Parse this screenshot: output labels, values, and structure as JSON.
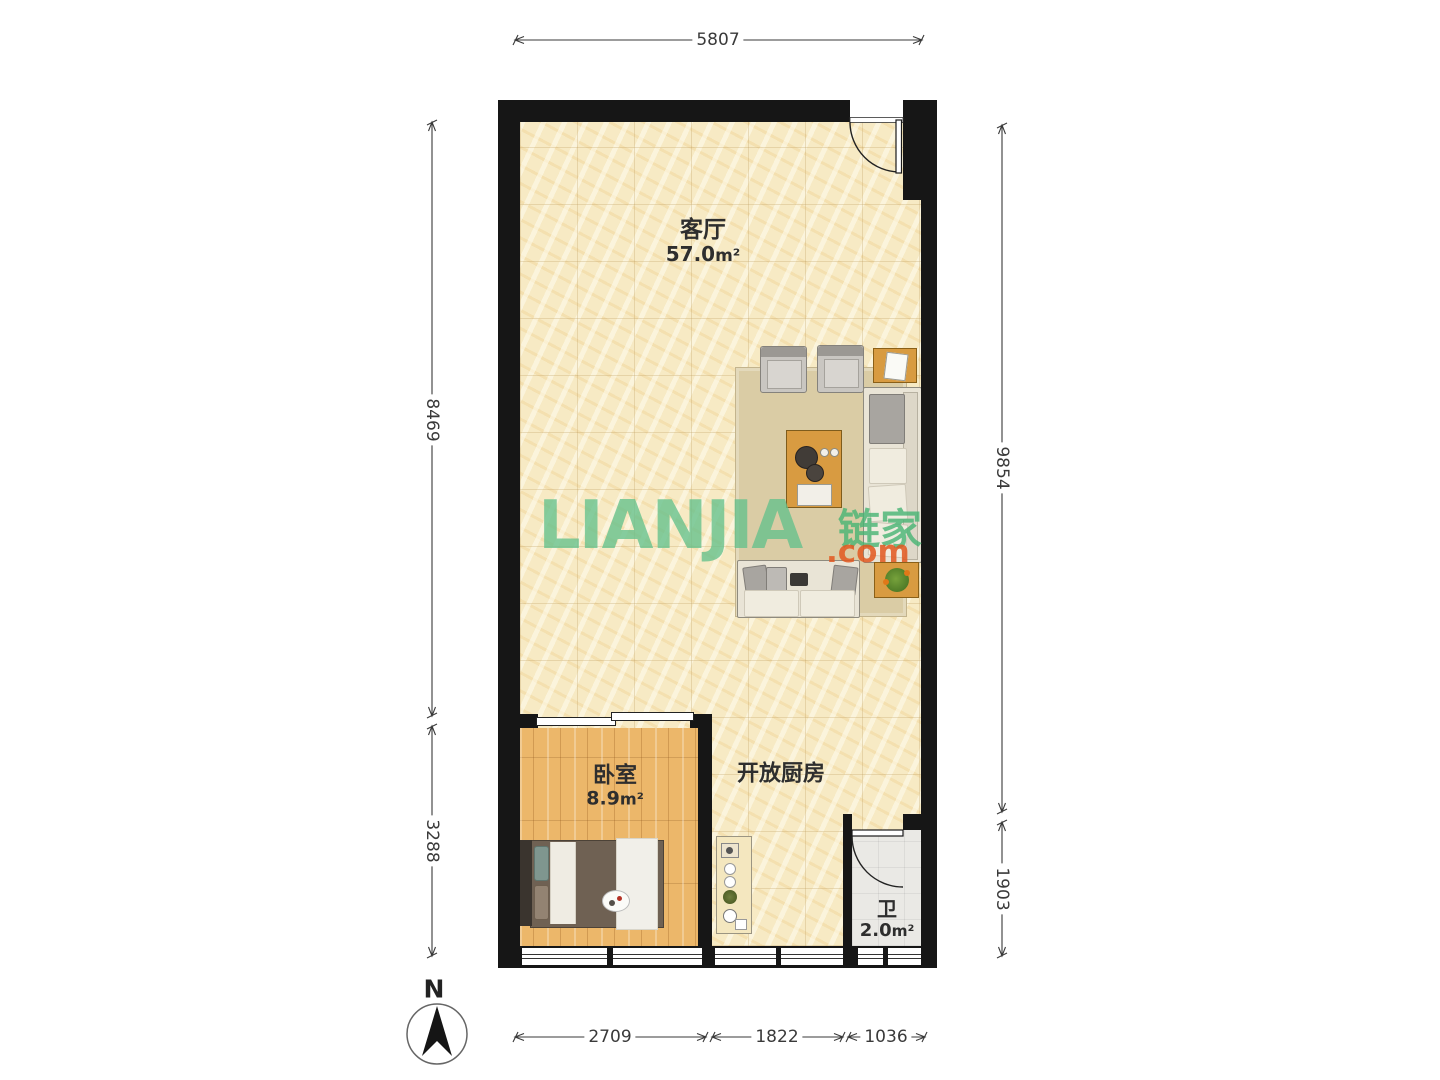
{
  "watermark": {
    "wordmark": "LIANJIA",
    "cn": "链家",
    "domain": ".com"
  },
  "rooms": {
    "living": {
      "name": "客厅",
      "area": "57.0",
      "unit": "m²"
    },
    "bedroom": {
      "name": "卧室",
      "area": "8.9",
      "unit": "m²"
    },
    "kitchen": {
      "name": "开放厨房"
    },
    "bath": {
      "name": "卫",
      "area": "2.0",
      "unit": "m²"
    }
  },
  "dimensions": {
    "top": "5807",
    "left_upper": "8469",
    "left_lower": "3288",
    "right_upper": "9854",
    "right_lower": "1903",
    "bottom_left": "2709",
    "bottom_middle": "1822",
    "bottom_right": "1036"
  },
  "compass": {
    "north": "N"
  },
  "colors": {
    "wall": "#161616",
    "living_floor": "#F7EAC4",
    "bedroom_floor": "#ECB76A",
    "bath_floor": "#EAE9E5",
    "wood_furniture": "#D89B41",
    "watermark_green": "#64C08C",
    "watermark_orange": "#E2571E",
    "dimension_text": "#3A3A3A"
  }
}
